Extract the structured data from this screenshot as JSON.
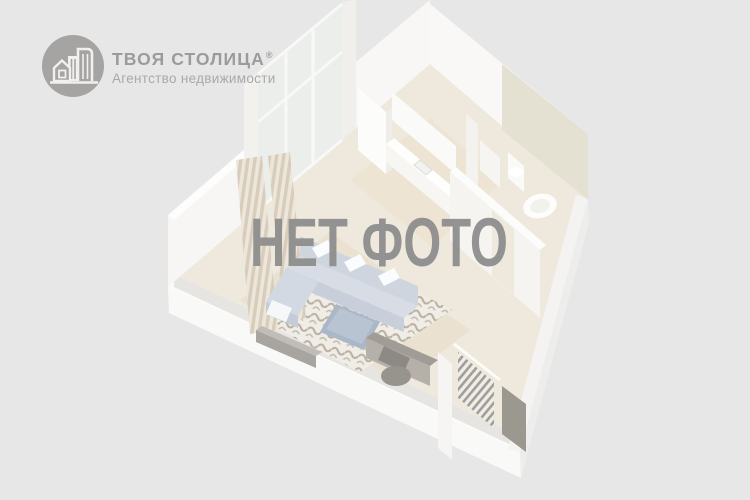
{
  "background": {
    "color": "#e8e7e7"
  },
  "brand": {
    "logo_icon": "buildings-in-circle",
    "logo_circle_color": "#a6a4a2",
    "name": "ТВОЯ СТОЛИЦА",
    "trademark": "®",
    "name_color": "#9b9b9b",
    "tagline": "Агентство недвижимости",
    "tagline_color": "#a9a9a9"
  },
  "watermark": {
    "text": "НЕТ ФОТО",
    "color": "#8d8d8d"
  },
  "illustration": {
    "name": "faded-3d-floorplan-render",
    "description": "washed-out isometric 3D render of a studio apartment (balcony, kitchen, bathroom, living area with sofa and rug, hallway with wardrobe)"
  }
}
